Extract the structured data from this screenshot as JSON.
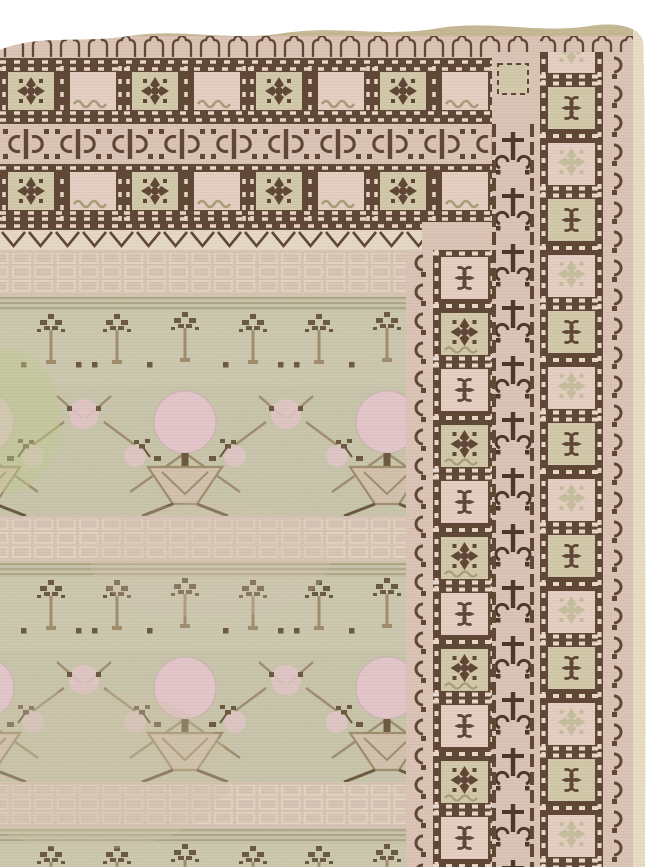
{
  "scene": {
    "subject": "Photograph of an antique pale Khotan-style carpet, top-right corner detail",
    "field_description": "Sage-green field with repeating rows of pomegranate trees: triangular vases, trunks, dark leaf sprigs, tan trellis vines and round pink pomegranates, plus pale pink garden-wall bands",
    "border_description": "Brown-on-cream borders: pointed-arch guard row, two bands of alternating plain and rosette squares framed by dashed lines, a dark bowtie-chain band, a zigzag guard, and on the right side film-strip square columns with hook guard stripes and a cream selvage edge",
    "motifs": [
      "pointed-arch",
      "rosette-square",
      "bowtie",
      "zigzag",
      "hook",
      "chain-cross",
      "pomegranate",
      "vase",
      "leaf-sprig",
      "garden-wall-box"
    ]
  },
  "palette": {
    "page_bg": "#ffffff",
    "selvage_khaki": "#c6b894",
    "selvage_cream": "#e9dec4",
    "border_pink": "#dcc5b7",
    "border_pink_light": "#e5d0c3",
    "sage": "#c6bf9e",
    "sage_light": "#d2caa9",
    "brown": "#5d4433",
    "brown_dark": "#47342a",
    "field_green": "#c6c6aa",
    "field_green_light": "#d0ccb2",
    "field_pink_band": "#d7c5b6",
    "pomegranate_pink": "#e4c7cd",
    "leaf_brown": "#615137",
    "vine_tan": "#9b8a68",
    "abrash_green": "#becb8e",
    "zigzag_cream": "#e6dac6",
    "dash_light": "#ead9c8",
    "wave_tan": "#a89c78",
    "wall_line": "#e4d6c2",
    "vase_fill": "#d2c2ad"
  }
}
